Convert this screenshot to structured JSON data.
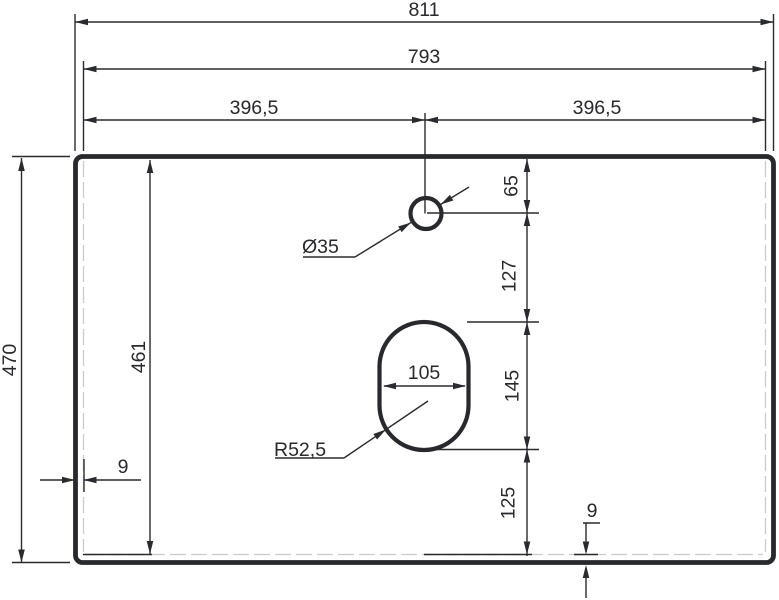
{
  "page": {
    "background": "#ffffff"
  },
  "drawing": {
    "type": "technical-drawing",
    "subject": "countertop top view with faucet hole and basin cutout",
    "line_color": "#2a2b2e",
    "faint_line_color": "#c9cbce",
    "dims": {
      "overall_width": "811",
      "inner_width": "793",
      "half_width_left": "396,5",
      "half_width_right": "396,5",
      "overall_depth": "470",
      "inner_depth": "461",
      "rim_left": "9",
      "rim_bottom": "9",
      "hole_diameter": "Ø35",
      "hole_from_top": "65",
      "hole_to_cutout": "127",
      "cutout_height": "145",
      "cutout_width": "105",
      "cutout_corner_radius": "R52,5",
      "cutout_to_bottom": "125"
    }
  }
}
